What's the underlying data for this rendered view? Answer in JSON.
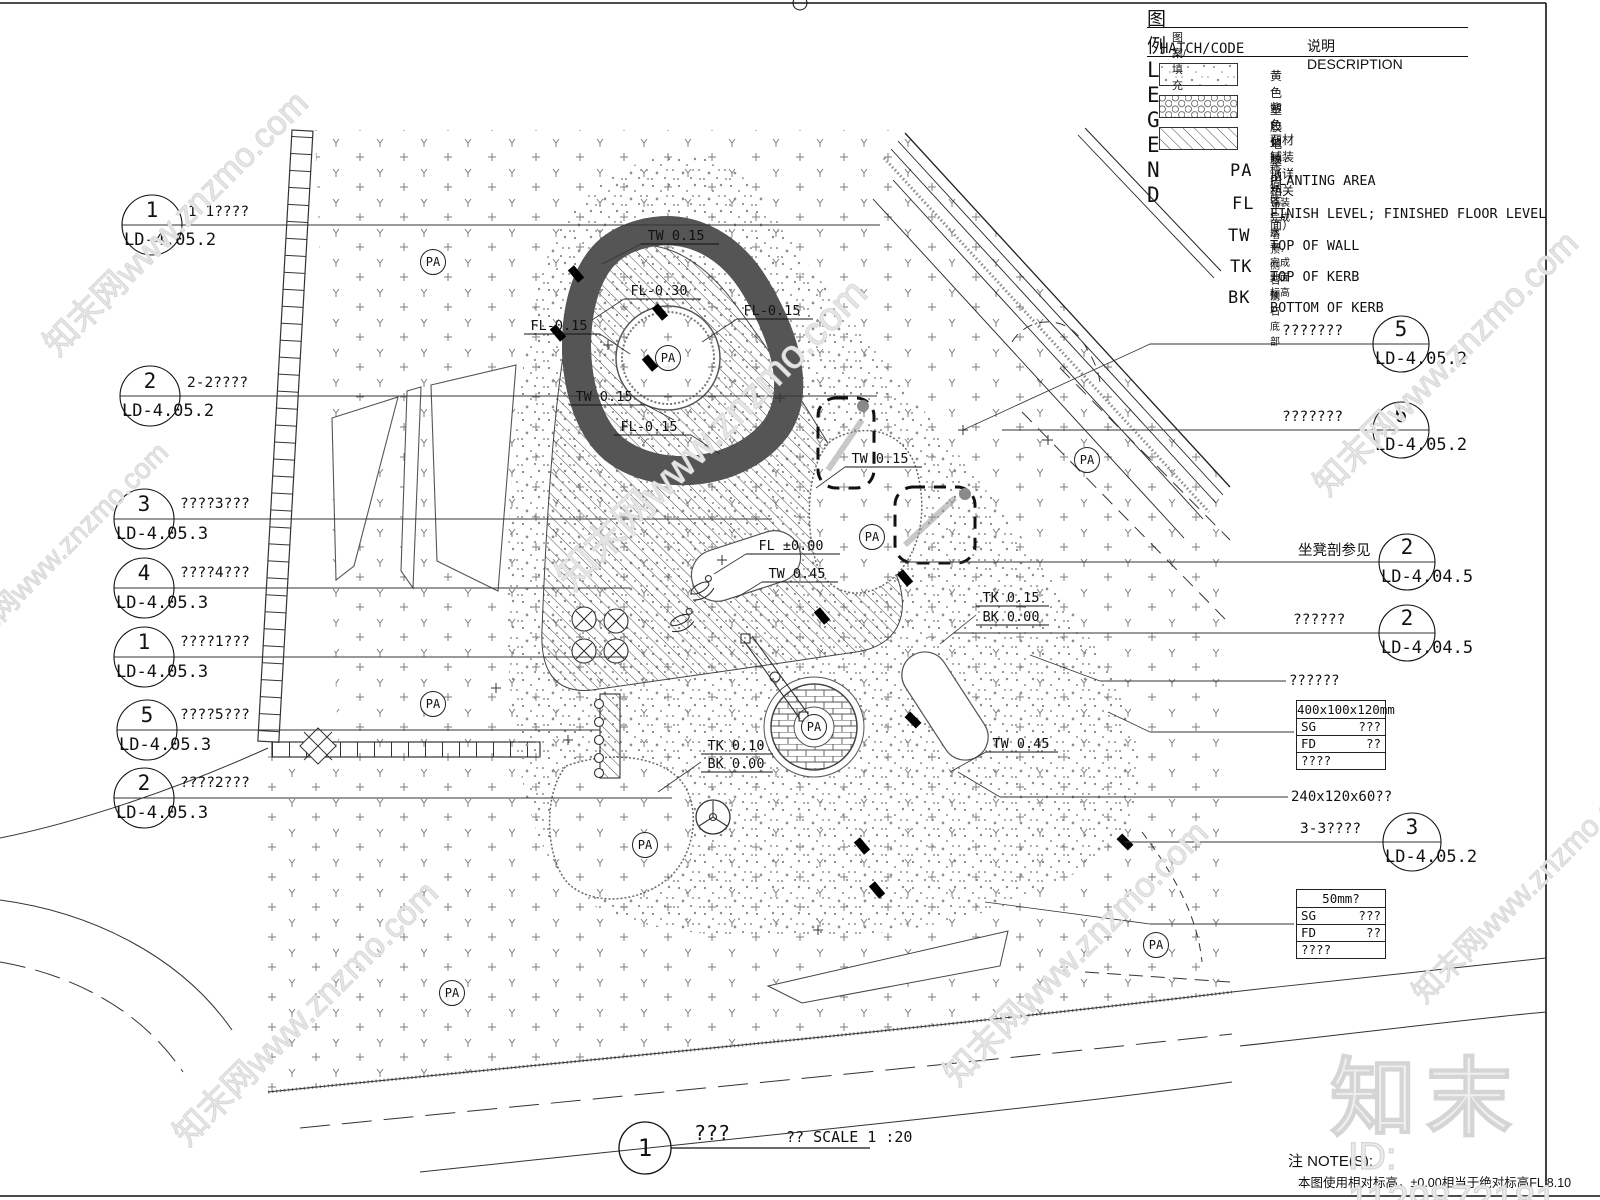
{
  "legend": {
    "title_zh": "图例",
    "title_en": "L E G E N D",
    "col_hatch_zh": "图案/填充",
    "col_hatch_en": "HATCH/CODE",
    "col_desc": "说明 DESCRIPTION",
    "hatch_items": [
      {
        "desc": "黄色塑胶地垫"
      },
      {
        "desc": "紫色塑胶地垫"
      },
      {
        "desc": "石材铺装（详相关平面）"
      }
    ],
    "codes": [
      {
        "code": "PA",
        "zh": "种植区",
        "en": "PLANTING AREA"
      },
      {
        "code": "FL",
        "zh": "铺装完成水平，完成地面标高",
        "en": "FINISH LEVEL; FINISHED FLOOR LEVEL"
      },
      {
        "code": "TW",
        "zh": "墙顶",
        "en": "TOP OF WALL"
      },
      {
        "code": "TK",
        "zh": "侧石顶",
        "en": "TOP OF KERB"
      },
      {
        "code": "BK",
        "zh": "侧石底部",
        "en": "BOTTOM OF KERB"
      }
    ]
  },
  "callouts": [
    {
      "num": "1",
      "ref": "LD-4.05.2",
      "label": "1-1????",
      "cx": 152,
      "cy": 225,
      "r": 30,
      "side": "left",
      "label_x": 188,
      "label_y": 216,
      "leader_end": 880
    },
    {
      "num": "2",
      "ref": "LD-4.05.2",
      "label": "2-2????",
      "cx": 150,
      "cy": 396,
      "r": 30,
      "side": "left",
      "label_x": 187,
      "label_y": 387,
      "leader_end": 877
    },
    {
      "num": "3",
      "ref": "LD-4.05.3",
      "label": "????3???",
      "cx": 144,
      "cy": 519,
      "r": 30,
      "side": "left",
      "label_x": 180,
      "label_y": 508,
      "leader_end": 772
    },
    {
      "num": "4",
      "ref": "LD-4.05.3",
      "label": "????4???",
      "cx": 144,
      "cy": 588,
      "r": 30,
      "side": "left",
      "label_x": 180,
      "label_y": 577,
      "leader_end": 630
    },
    {
      "num": "1",
      "ref": "LD-4.05.3",
      "label": "????1???",
      "cx": 144,
      "cy": 657,
      "r": 30,
      "side": "left",
      "label_x": 180,
      "label_y": 646,
      "leader_end": 627
    },
    {
      "num": "5",
      "ref": "LD-4.05.3",
      "label": "????5???",
      "cx": 147,
      "cy": 730,
      "r": 30,
      "side": "left",
      "label_x": 180,
      "label_y": 719,
      "leader_end": 600
    },
    {
      "num": "2",
      "ref": "LD-4.05.3",
      "label": "????2???",
      "cx": 144,
      "cy": 798,
      "r": 30,
      "side": "left",
      "label_x": 180,
      "label_y": 787,
      "leader_end": 672
    },
    {
      "num": "5",
      "ref": "LD-4.05.2",
      "label": "???????",
      "cx": 1401,
      "cy": 344,
      "r": 28,
      "side": "right",
      "label_x": 1282,
      "label_y": 335,
      "leader_end": 1150
    },
    {
      "num": "6",
      "ref": "LD-4.05.2",
      "label": "???????",
      "cx": 1401,
      "cy": 430,
      "r": 28,
      "side": "right",
      "label_x": 1282,
      "label_y": 421,
      "leader_end": 1002
    },
    {
      "num": "2",
      "ref": "LD-4.04.5",
      "label": "坐凳剖参见",
      "cx": 1407,
      "cy": 562,
      "r": 28,
      "side": "right",
      "label_x": 1298,
      "label_y": 555,
      "leader_end": 900
    },
    {
      "num": "2",
      "ref": "LD-4.04.5",
      "label": "??????",
      "cx": 1407,
      "cy": 633,
      "r": 28,
      "side": "right",
      "label_x": 1293,
      "label_y": 624,
      "leader_end": 953
    },
    {
      "num": "3",
      "ref": "LD-4.05.2",
      "label": "3-3????",
      "cx": 1412,
      "cy": 842,
      "r": 29,
      "side": "right",
      "label_x": 1300,
      "label_y": 833,
      "leader_end": 1125
    }
  ],
  "leader_labels": [
    {
      "text": "??????",
      "x": 1289,
      "y": 685,
      "leader": [
        1100,
        681,
        1286,
        681
      ],
      "tail": [
        1100,
        681,
        1030,
        655
      ]
    },
    {
      "text": "240x120x60??",
      "x": 1291,
      "y": 801,
      "leader": [
        1000,
        797,
        1288,
        797
      ],
      "tail": [
        1000,
        797,
        958,
        772
      ]
    }
  ],
  "plan_labels": [
    {
      "t": "TW 0.15",
      "x": 676,
      "y": 240,
      "ul": [
        641,
        244,
        719,
        244
      ],
      "ld": [
        641,
        244,
        602,
        264
      ]
    },
    {
      "t": "FL-0.30",
      "x": 659,
      "y": 295,
      "ul": [
        624,
        299,
        701,
        299
      ],
      "ld": [
        624,
        299,
        592,
        320
      ]
    },
    {
      "t": "FL-0.15",
      "x": 772,
      "y": 315,
      "ul": [
        737,
        319,
        813,
        319
      ],
      "ld": [
        737,
        319,
        702,
        342
      ]
    },
    {
      "t": "FL-0.15",
      "x": 559,
      "y": 330,
      "ul": [
        524,
        334,
        600,
        334
      ],
      "ld": [
        600,
        334,
        630,
        354
      ]
    },
    {
      "t": "TW 0.15",
      "x": 604,
      "y": 401,
      "ul": [
        569,
        405,
        646,
        405
      ],
      "ld": [
        646,
        405,
        674,
        420
      ]
    },
    {
      "t": "FL-0.15",
      "x": 649,
      "y": 431,
      "ul": [
        614,
        435,
        691,
        435
      ],
      "ld": [
        691,
        435,
        720,
        454
      ]
    },
    {
      "t": "TW 0.15",
      "x": 880,
      "y": 463,
      "ul": [
        845,
        467,
        922,
        467
      ],
      "ld": [
        845,
        467,
        816,
        488
      ]
    },
    {
      "t": "FL ±0.00",
      "x": 791,
      "y": 550,
      "ul": [
        746,
        554,
        840,
        554
      ],
      "ld": [
        746,
        554,
        714,
        574
      ]
    },
    {
      "t": "TW 0.45",
      "x": 797,
      "y": 578,
      "ul": [
        762,
        582,
        838,
        582
      ],
      "ld": [
        762,
        582,
        736,
        598
      ]
    },
    {
      "t": "TK 0.15",
      "x": 1011,
      "y": 602,
      "ul": [
        976,
        606,
        1049,
        606
      ]
    },
    {
      "t": "BK 0.00",
      "x": 1011,
      "y": 621,
      "ul": [
        976,
        625,
        1049,
        625
      ],
      "ld": [
        976,
        615,
        940,
        644
      ]
    },
    {
      "t": "TK 0.10",
      "x": 736,
      "y": 750,
      "ul": [
        701,
        754,
        773,
        754
      ]
    },
    {
      "t": "BK 0.00",
      "x": 736,
      "y": 768,
      "ul": [
        701,
        772,
        773,
        772
      ],
      "ld": [
        701,
        762,
        658,
        792
      ]
    },
    {
      "t": "TW 0.45",
      "x": 1021,
      "y": 748,
      "ul": [
        986,
        752,
        1058,
        752
      ],
      "ld": [
        986,
        752,
        950,
        772
      ]
    }
  ],
  "pa_label": "PA",
  "pa_positions": [
    {
      "x": 433,
      "y": 262
    },
    {
      "x": 668,
      "y": 358
    },
    {
      "x": 872,
      "y": 537
    },
    {
      "x": 433,
      "y": 704
    },
    {
      "x": 645,
      "y": 845
    },
    {
      "x": 814,
      "y": 727
    },
    {
      "x": 1087,
      "y": 460
    },
    {
      "x": 452,
      "y": 993
    },
    {
      "x": 1156,
      "y": 945
    }
  ],
  "spec_tables": [
    {
      "x": 1296,
      "y": 700,
      "header": "400x100x120mm",
      "rows": [
        [
          "SG",
          "???"
        ],
        [
          "FD",
          "??"
        ]
      ],
      "footer": "????",
      "leader": [
        1150,
        732,
        1294,
        732
      ],
      "tail": [
        1150,
        732,
        1108,
        712
      ]
    },
    {
      "x": 1296,
      "y": 889,
      "header": "50mm?",
      "rows": [
        [
          "SG",
          "???"
        ],
        [
          "FD",
          "??"
        ]
      ],
      "footer": "????",
      "leader": [
        1150,
        924,
        1294,
        924
      ],
      "tail": [
        1150,
        924,
        985,
        902
      ]
    }
  ],
  "title_block": {
    "number": "1",
    "name": "???",
    "scale_text": "?? SCALE 1 :20"
  },
  "notes": {
    "label": "注 NOTE(S):",
    "text": "本图使用相对标高，±0.00相当于绝对标高FL 8.10"
  },
  "watermarks": {
    "site": "知末网www.znzmo.com",
    "logo": "知末",
    "id_text": "ID: 1129872181"
  }
}
